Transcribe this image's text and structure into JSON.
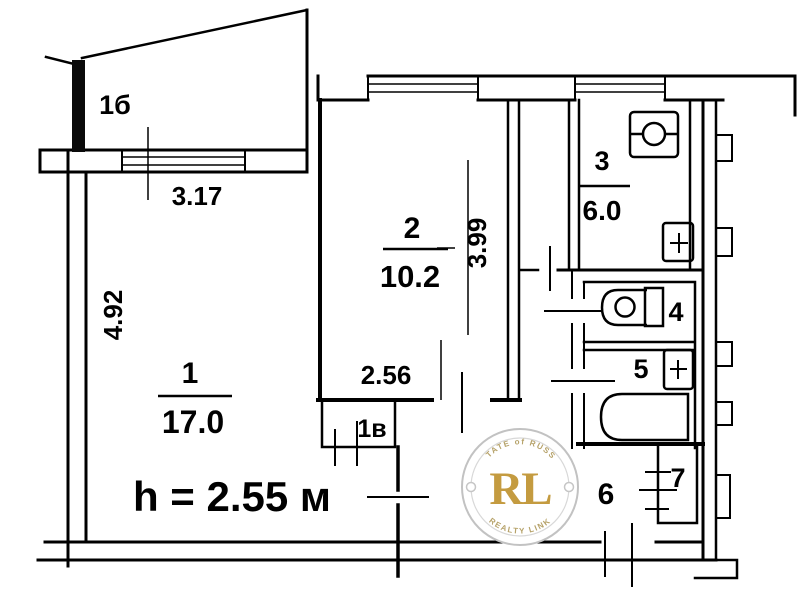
{
  "plan": {
    "balcony": {
      "label": "1б",
      "dim": "3.17"
    },
    "room1": {
      "num": "1",
      "area": "17.0",
      "dim_v": "4.92",
      "note": "h = 2.55 м"
    },
    "room2": {
      "num": "2",
      "area": "10.2",
      "dim_v": "3.99",
      "dim_h": "2.56"
    },
    "closet1v": {
      "label": "1в"
    },
    "kitchen": {
      "num": "3",
      "area": "6.0"
    },
    "wc": {
      "num": "4"
    },
    "bath": {
      "num": "5"
    },
    "hall": {
      "num": "6"
    },
    "pantry": {
      "num": "7"
    }
  },
  "watermark": {
    "monogram": "RL",
    "arc_top": "ESTATE of RUSSIA",
    "arc_bottom": "REALTY LINK",
    "gold": "#c49b40",
    "ring_color": "#c2c2c2"
  }
}
